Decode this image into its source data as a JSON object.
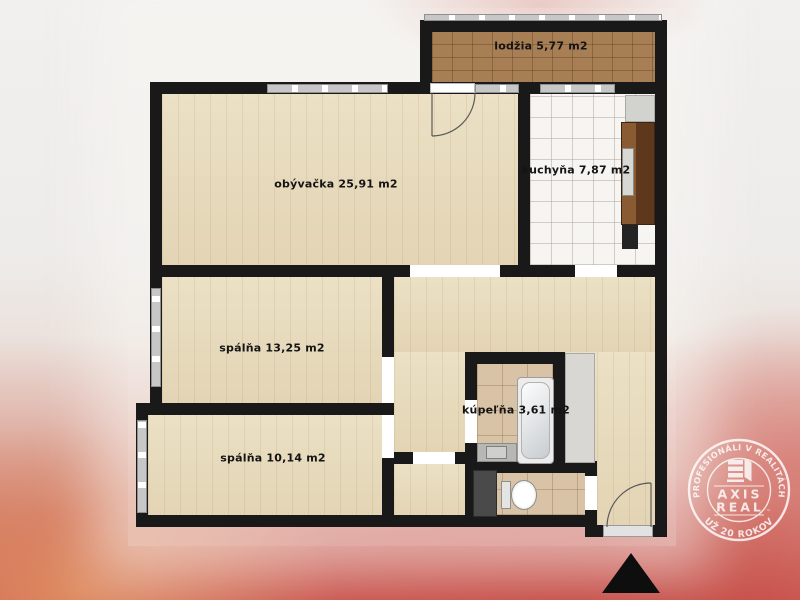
{
  "plan": {
    "rooms": [
      {
        "id": "lodzia",
        "label": "lodžia 5,77 m2"
      },
      {
        "id": "obyvacka",
        "label": "obývačka 25,91 m2"
      },
      {
        "id": "kuchyna",
        "label": "kuchyňa 7,87 m2"
      },
      {
        "id": "spalna-1",
        "label": "spálňa 13,25 m2"
      },
      {
        "id": "spalna-2",
        "label": "spálňa 10,14 m2"
      },
      {
        "id": "kupelna",
        "label": "kúpeľňa 3,61 m2"
      }
    ]
  },
  "watermark": {
    "arc_top": "PROFESIONÁLI V REALITÁCH",
    "arc_bottom": "UŽ 20 ROKOV",
    "brand_top": "AXIS",
    "brand_bottom": "REAL",
    "tm": "™"
  },
  "icons": {
    "north_arrow": "solid-black-triangle-up",
    "entrance_door": "quarter-arc-door-swing",
    "balcony_door": "quarter-arc-door-swing"
  },
  "colors": {
    "wall": "#191919",
    "wood_floor": "#e9dcbd",
    "loggia_tile": "#a87e55",
    "kitchen_tile": "#f7f5f1",
    "bath_tile": "#d9c3a7",
    "window_gray": "#c7c7c7",
    "counter_brown": "#6f4527",
    "carpet_red": "#c8544c"
  }
}
